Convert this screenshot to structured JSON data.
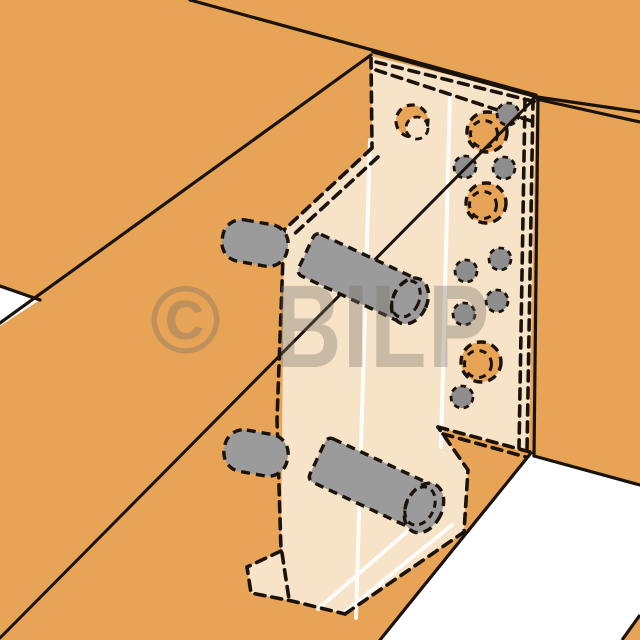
{
  "watermark": {
    "copyright_symbol": "©",
    "brand": "BILP"
  },
  "colors": {
    "wood": "#E7A356",
    "bracket": "#F7E3C8",
    "dowel": "#9B9B9B",
    "pin": "#8E8E8E",
    "outline": "#1B130B",
    "background": "#FFFFFF",
    "highlight": "#FFFFFF",
    "watermark": "rgba(120,113,103,0.36)"
  },
  "scene": {
    "large_holes": 3,
    "small_pins": 8,
    "dowels": 4
  }
}
